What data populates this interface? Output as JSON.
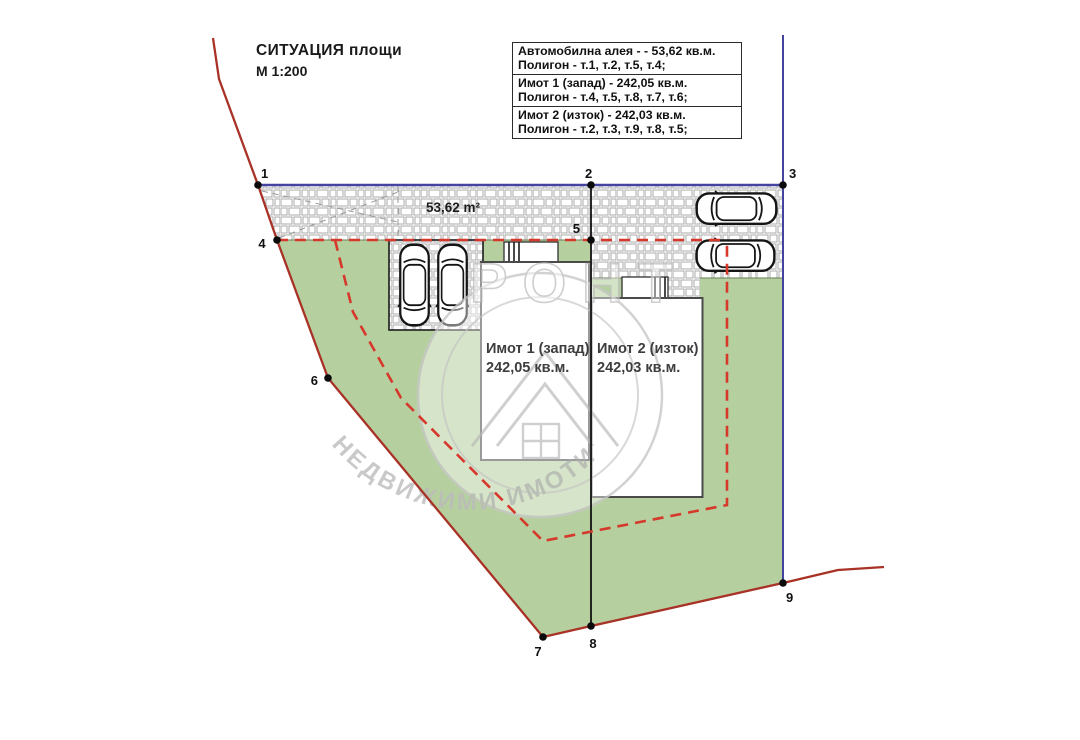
{
  "title": {
    "main": "СИТУАЦИЯ площи",
    "scale": "М 1:200"
  },
  "legend": {
    "rows": [
      {
        "line1": "Автомобилна алея - - 53,62 кв.м.",
        "line2": "Полигон - т.1, т.2, т.5, т.4;"
      },
      {
        "line1": "Имот 1 (запад) - 242,05 кв.м.",
        "line2": "Полигон - т.4, т.5, т.8, т.7, т.6;"
      },
      {
        "line1": "Имот 2 (изток) - 242,03 кв.м.",
        "line2": "Полигон - т.2, т.3, т.9, т.8, т.5;"
      }
    ]
  },
  "plan": {
    "alley_area_label": "53,62 m²",
    "lot1": {
      "name": "Имот 1 (запад)",
      "area": "242,05 кв.м."
    },
    "lot2": {
      "name": "Имот 2 (изток)",
      "area": "242,03 кв.м."
    },
    "points": [
      {
        "label": "1"
      },
      {
        "label": "2"
      },
      {
        "label": "3"
      },
      {
        "label": "4"
      },
      {
        "label": "5"
      },
      {
        "label": "6"
      },
      {
        "label": "7"
      },
      {
        "label": "8"
      },
      {
        "label": "9"
      }
    ]
  },
  "watermark": {
    "top_text": "РОНТ",
    "arc_text": "НЕДВИЖИМИ ИМОТИ"
  },
  "colors": {
    "green_area": "#b6cf9f",
    "boundary_red": "#a93226",
    "setback_dashed_red": "#d6382b",
    "street_blue": "#44449e",
    "divider_black": "#111111"
  }
}
